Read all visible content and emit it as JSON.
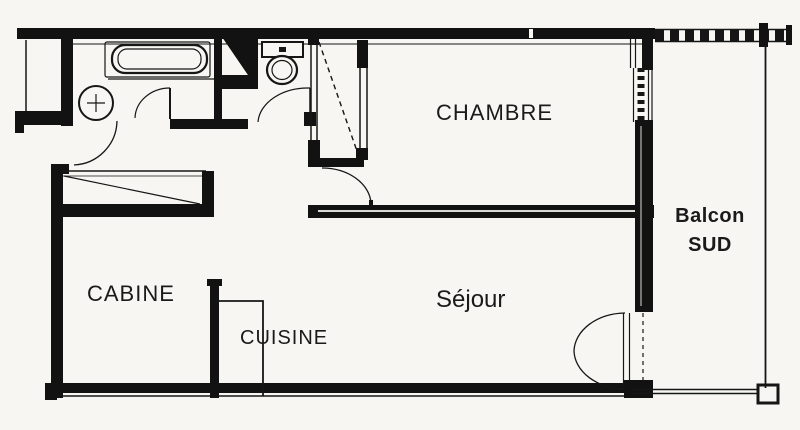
{
  "palette": {
    "paper": "#f7f6f2",
    "ink": "#161616"
  },
  "plan": {
    "rooms": {
      "chambre": {
        "label": "CHAMBRE"
      },
      "sejour": {
        "label": "Séjour"
      },
      "cabine": {
        "label": "CABINE"
      },
      "cuisine": {
        "label": "CUISINE"
      },
      "balcon": {
        "line1": "Balcon",
        "line2": "SUD"
      }
    },
    "fixtures": {
      "bathtub": "bathtub",
      "washbasin": "washbasin-with-cross",
      "toilet": "toilet-with-cistern",
      "wardrobe": "wardrobe-dashed-diagonal",
      "cabine_closet": "closet-diagonal",
      "kitchen_counter": "kitchen-counter-line",
      "balcony_rail": "balcony-railing-hatched"
    }
  }
}
